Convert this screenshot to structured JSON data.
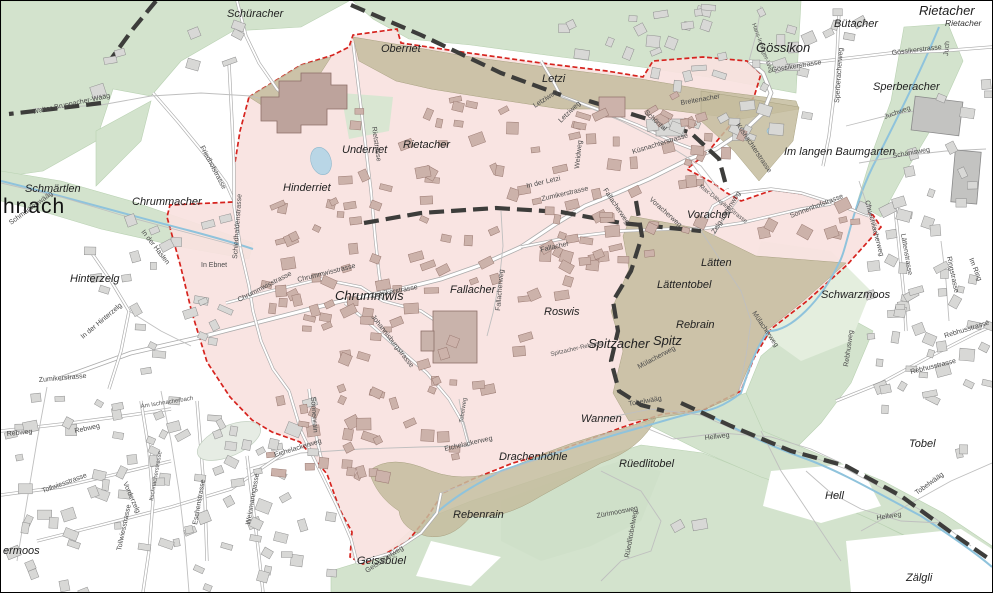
{
  "map": {
    "colors": {
      "zone_fill": "#f9e2df",
      "zone_border": "#d6231e",
      "forest": "#d3e3cd",
      "forest_pale": "#e4eede",
      "wooded_olive": "#c4bc9d",
      "water": "#8fc3dc",
      "municipal_boundary": "#3d3d3b",
      "road_casing": "#ababab",
      "building_out": "#d8d8d6",
      "building_in": "#ccb2aa"
    },
    "labels": [
      {
        "t": "hnach",
        "x": 2,
        "y": 212,
        "c": "town"
      },
      {
        "t": "Schüracher",
        "x": 226,
        "y": 16,
        "c": "area"
      },
      {
        "t": "Oberriet",
        "x": 380,
        "y": 51,
        "c": "area"
      },
      {
        "t": "Letzi",
        "x": 541,
        "y": 81,
        "c": "area"
      },
      {
        "t": "Gössikon",
        "x": 755,
        "y": 51,
        "c": "areaL"
      },
      {
        "t": "Bütacher",
        "x": 833,
        "y": 26,
        "c": "area"
      },
      {
        "t": "Rietacher",
        "x": 918,
        "y": 14,
        "c": "areaL"
      },
      {
        "t": "Rietacher",
        "x": 944,
        "y": 25,
        "c": "areaS"
      },
      {
        "t": "Sperberacher",
        "x": 872,
        "y": 89,
        "c": "area"
      },
      {
        "t": "Im langen Baumgarten",
        "x": 783,
        "y": 154,
        "c": "area"
      },
      {
        "t": "Underriet",
        "x": 341,
        "y": 152,
        "c": "area"
      },
      {
        "t": "Rietacher",
        "x": 402,
        "y": 147,
        "c": "area"
      },
      {
        "t": "Hinderriet",
        "x": 282,
        "y": 190,
        "c": "area"
      },
      {
        "t": "Schmärtlen",
        "x": 24,
        "y": 191,
        "c": "area"
      },
      {
        "t": "Chrummacher",
        "x": 131,
        "y": 204,
        "c": "area"
      },
      {
        "t": "Hinterzelg",
        "x": 69,
        "y": 281,
        "c": "area"
      },
      {
        "t": "Chrummwis",
        "x": 334,
        "y": 299,
        "c": "areaL"
      },
      {
        "t": "Fallacher",
        "x": 449,
        "y": 292,
        "c": "area"
      },
      {
        "t": "Roswis",
        "x": 543,
        "y": 314,
        "c": "area"
      },
      {
        "t": "Lätten",
        "x": 700,
        "y": 265,
        "c": "area"
      },
      {
        "t": "Lättentobel",
        "x": 656,
        "y": 287,
        "c": "area"
      },
      {
        "t": "Voracher",
        "x": 686,
        "y": 217,
        "c": "area"
      },
      {
        "t": "Rebrain",
        "x": 675,
        "y": 327,
        "c": "area"
      },
      {
        "t": "Spitzacher",
        "x": 587,
        "y": 347,
        "c": "areaL"
      },
      {
        "t": "Spitz",
        "x": 652,
        "y": 344,
        "c": "areaL"
      },
      {
        "t": "Schwarzmoos",
        "x": 820,
        "y": 297,
        "c": "area"
      },
      {
        "t": "Wannen",
        "x": 580,
        "y": 421,
        "c": "area"
      },
      {
        "t": "Drachenhöhle",
        "x": 498,
        "y": 459,
        "c": "area"
      },
      {
        "t": "Rebenrain",
        "x": 452,
        "y": 517,
        "c": "area"
      },
      {
        "t": "Geissbüel",
        "x": 356,
        "y": 563,
        "c": "area"
      },
      {
        "t": "Rüedlitobel",
        "x": 618,
        "y": 466,
        "c": "area"
      },
      {
        "t": "Tobel",
        "x": 908,
        "y": 446,
        "c": "area"
      },
      {
        "t": "Hell",
        "x": 824,
        "y": 498,
        "c": "area"
      },
      {
        "t": "Zälgli",
        "x": 905,
        "y": 580,
        "c": "area"
      },
      {
        "t": "ermoos",
        "x": 2,
        "y": 553,
        "c": "area"
      },
      {
        "t": "Walter-Bruppacher-Wääg",
        "x": 32,
        "y": 113,
        "r": -12,
        "c": "street"
      },
      {
        "t": "Schmärtlenwääg",
        "x": 10,
        "y": 224,
        "r": -36,
        "c": "street"
      },
      {
        "t": "Friedhofstrasse",
        "x": 199,
        "y": 146,
        "r": 62,
        "c": "street"
      },
      {
        "t": "Schiedhaldenstrasse",
        "x": 236,
        "y": 258,
        "r": -86,
        "c": "street"
      },
      {
        "t": "In der Haslen",
        "x": 140,
        "y": 231,
        "r": 52,
        "c": "street"
      },
      {
        "t": "In Ebnet",
        "x": 200,
        "y": 266,
        "c": "street"
      },
      {
        "t": "Chrummwisstrasse",
        "x": 238,
        "y": 301,
        "r": -27,
        "c": "street"
      },
      {
        "t": "Chrummwisstrasse",
        "x": 297,
        "y": 281,
        "r": -14,
        "c": "street"
      },
      {
        "t": "Zumikerstrasse",
        "x": 370,
        "y": 297,
        "r": -11,
        "c": "street"
      },
      {
        "t": "Johannisburgstrasse",
        "x": 370,
        "y": 316,
        "r": 52,
        "c": "street"
      },
      {
        "t": "Sonnenrain",
        "x": 310,
        "y": 396,
        "r": 86,
        "c": "street"
      },
      {
        "t": "Rietstrasse",
        "x": 371,
        "y": 126,
        "r": 82,
        "c": "street"
      },
      {
        "t": "Letziweg",
        "x": 534,
        "y": 107,
        "r": -33,
        "c": "street"
      },
      {
        "t": "Letziweg",
        "x": 560,
        "y": 122,
        "r": -44,
        "c": "street"
      },
      {
        "t": "In der Letzi",
        "x": 526,
        "y": 187,
        "r": -13,
        "c": "street"
      },
      {
        "t": "Zumikerstrasse",
        "x": 541,
        "y": 200,
        "r": -13,
        "c": "street"
      },
      {
        "t": "Weidweg",
        "x": 578,
        "y": 168,
        "r": -84,
        "c": "street"
      },
      {
        "t": "Küsnachterstrasse",
        "x": 632,
        "y": 153,
        "r": -17,
        "c": "street"
      },
      {
        "t": "Küsnachterstrasse",
        "x": 735,
        "y": 124,
        "r": 56,
        "c": "street"
      },
      {
        "t": "Fallacherweg",
        "x": 602,
        "y": 189,
        "r": 56,
        "c": "street"
      },
      {
        "t": "Fallacherweg",
        "x": 499,
        "y": 310,
        "r": -85,
        "c": "street"
      },
      {
        "t": "Fallacher",
        "x": 540,
        "y": 251,
        "r": -13,
        "c": "street"
      },
      {
        "t": "Max-Dätwyler-Strasse",
        "x": 698,
        "y": 186,
        "r": 38,
        "c": "streetS"
      },
      {
        "t": "Breitenacher",
        "x": 680,
        "y": 104,
        "r": -10,
        "c": "street"
      },
      {
        "t": "Schöntal",
        "x": 643,
        "y": 112,
        "r": 42,
        "c": "street"
      },
      {
        "t": "Gössikerstrasse",
        "x": 771,
        "y": 71,
        "r": -9,
        "c": "street"
      },
      {
        "t": "Gössikerstrasse",
        "x": 891,
        "y": 54,
        "r": -7,
        "c": "street"
      },
      {
        "t": "Hans-Irminger-Weg",
        "x": 751,
        "y": 23,
        "r": 70,
        "c": "streetS"
      },
      {
        "t": "Sperberacherweg",
        "x": 838,
        "y": 102,
        "r": -86,
        "c": "street"
      },
      {
        "t": "Juch",
        "x": 947,
        "y": 55,
        "r": -85,
        "c": "street"
      },
      {
        "t": "Juchweg",
        "x": 884,
        "y": 118,
        "r": -20,
        "c": "street"
      },
      {
        "t": "Schänisweg",
        "x": 892,
        "y": 157,
        "r": -10,
        "c": "street"
      },
      {
        "t": "Sonnenhofstrasse",
        "x": 790,
        "y": 217,
        "r": -21,
        "c": "street"
      },
      {
        "t": "Zelg-Lättenweg",
        "x": 714,
        "y": 233,
        "r": -58,
        "c": "street"
      },
      {
        "t": "Voracherweg",
        "x": 648,
        "y": 199,
        "r": 42,
        "c": "street"
      },
      {
        "t": "Chuechliacherweg",
        "x": 864,
        "y": 200,
        "r": 75,
        "c": "street"
      },
      {
        "t": "Lättenstrasse",
        "x": 900,
        "y": 233,
        "r": 80,
        "c": "street"
      },
      {
        "t": "Ringstrasse",
        "x": 946,
        "y": 256,
        "r": 78,
        "c": "street"
      },
      {
        "t": "Im Ring",
        "x": 968,
        "y": 258,
        "r": 68,
        "c": "street"
      },
      {
        "t": "Rebhusstrasse",
        "x": 944,
        "y": 337,
        "r": -17,
        "c": "street"
      },
      {
        "t": "Rebhusstrasse",
        "x": 910,
        "y": 373,
        "r": -14,
        "c": "street"
      },
      {
        "t": "Rebhusweg",
        "x": 847,
        "y": 366,
        "r": -82,
        "c": "street"
      },
      {
        "t": "Mülacherweg",
        "x": 751,
        "y": 312,
        "r": 56,
        "c": "street"
      },
      {
        "t": "Mülacherweg",
        "x": 638,
        "y": 368,
        "r": -28,
        "c": "street"
      },
      {
        "t": "Spitzacher-Rebweg",
        "x": 550,
        "y": 355,
        "r": -13,
        "c": "streetS"
      },
      {
        "t": "Tobelwääg",
        "x": 628,
        "y": 405,
        "r": -10,
        "c": "street"
      },
      {
        "t": "Tobelwääg",
        "x": 916,
        "y": 494,
        "r": -36,
        "c": "street"
      },
      {
        "t": "Hellweg",
        "x": 704,
        "y": 439,
        "r": -7,
        "c": "street"
      },
      {
        "t": "Hellweg",
        "x": 876,
        "y": 519,
        "r": -9,
        "c": "street"
      },
      {
        "t": "Zürimoosweg",
        "x": 596,
        "y": 517,
        "r": -11,
        "c": "street"
      },
      {
        "t": "Rüedlitobelweg",
        "x": 628,
        "y": 557,
        "r": -80,
        "c": "street"
      },
      {
        "t": "Eichelackerweg",
        "x": 274,
        "y": 456,
        "r": -17,
        "c": "street"
      },
      {
        "t": "Eichelackerweg",
        "x": 444,
        "y": 450,
        "r": -13,
        "c": "street"
      },
      {
        "t": "Tobelweg",
        "x": 462,
        "y": 422,
        "r": -82,
        "c": "streetS"
      },
      {
        "t": "Geissbüelweg",
        "x": 366,
        "y": 572,
        "r": -33,
        "c": "street"
      },
      {
        "t": "Zumikerstrasse",
        "x": 38,
        "y": 381,
        "r": -5,
        "c": "street"
      },
      {
        "t": "Rebweg",
        "x": 74,
        "y": 432,
        "r": -12,
        "c": "street"
      },
      {
        "t": "Rebweg",
        "x": 6,
        "y": 435,
        "r": -6,
        "c": "street"
      },
      {
        "t": "Tollwiesstrasse",
        "x": 42,
        "y": 492,
        "r": -20,
        "c": "street"
      },
      {
        "t": "Tollwiesstrasse",
        "x": 120,
        "y": 550,
        "r": -78,
        "c": "street"
      },
      {
        "t": "Vorderzelg",
        "x": 122,
        "y": 482,
        "r": 66,
        "c": "street"
      },
      {
        "t": "Eschenstrasse",
        "x": 196,
        "y": 524,
        "r": -80,
        "c": "street"
      },
      {
        "t": "Weinmanngasse",
        "x": 249,
        "y": 524,
        "r": -80,
        "c": "street"
      },
      {
        "t": "Am Ischnacherbach",
        "x": 140,
        "y": 407,
        "r": -9,
        "c": "streetS"
      },
      {
        "t": "Itschnacherstrasse",
        "x": 152,
        "y": 500,
        "r": -80,
        "c": "streetS"
      },
      {
        "t": "In der Hinterzelg",
        "x": 82,
        "y": 338,
        "r": -40,
        "c": "street"
      }
    ]
  }
}
